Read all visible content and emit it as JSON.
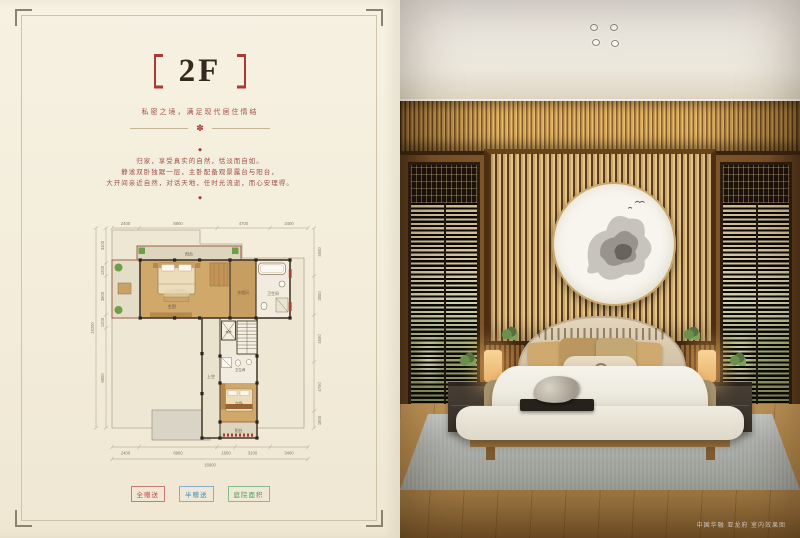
{
  "flyer": {
    "title": "2F",
    "brackets": "〔〕",
    "subtitle": "私密之境，满足现代居住情结",
    "medallion": "✽",
    "diamond": "◆",
    "paragraph": [
      "归家，享受真实的自然，恬淡而自如。",
      "静谧双卧独踞一层，主卧配备观景露台与阳台，",
      "大开间亲近自然，对话天地，任时光流逝，而心安理得。"
    ],
    "legend": [
      {
        "label": "全赠送",
        "color": "#bf4a42"
      },
      {
        "label": "半赠送",
        "color": "#3f8bc0"
      },
      {
        "label": "庭院面积",
        "color": "#4a9e57"
      }
    ],
    "colors": {
      "accent_red": "#a93a35",
      "text_red": "#9c4f46",
      "page_bg": "#f4eedf"
    }
  },
  "floorplan": {
    "dims_top": [
      "2400",
      "6900",
      "4700",
      "3400"
    ],
    "dims_bottom": [
      "2400",
      "6900",
      "1600",
      "3100",
      "3400"
    ],
    "total_bottom": "16800",
    "dims_left": [
      "3400",
      "1200",
      "3800",
      "1200",
      "9800"
    ],
    "total_left": "19200",
    "dims_right": [
      "4600",
      "3800",
      "4500",
      "4700",
      "1800"
    ],
    "rooms": {
      "balcony_top": "阳台",
      "master": "主卧",
      "cloak": "衣帽间",
      "bath": "卫生间",
      "void": "上空",
      "elevator": "电梯",
      "bath2": "卫生间",
      "bedroom2": "次卧",
      "balcony_bottom": "阳台"
    }
  },
  "photo": {
    "caption": "中国华融 亚龙府 室内效果图"
  }
}
